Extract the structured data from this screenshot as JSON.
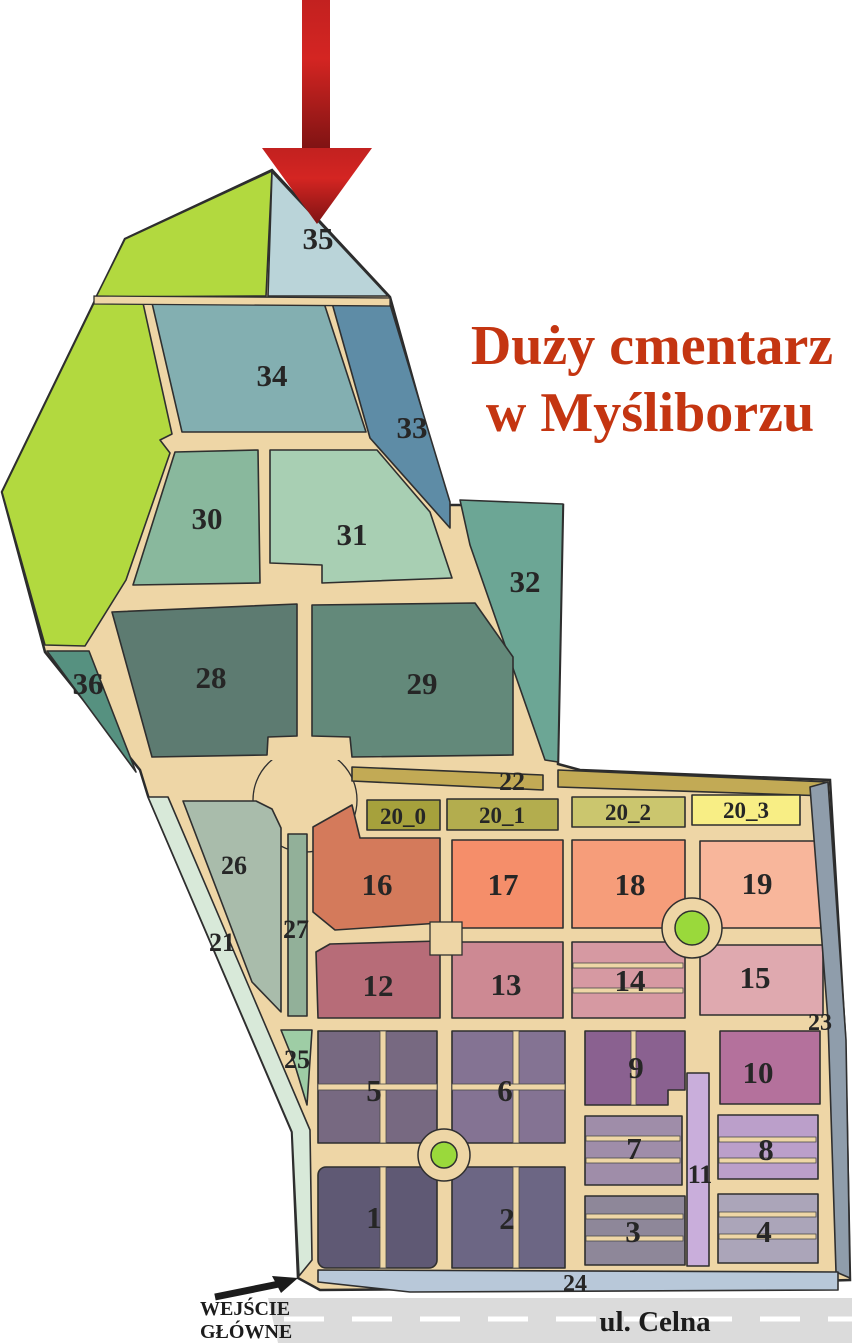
{
  "title": {
    "line1": "Duży cmentarz",
    "line2": "w Myśliborzu",
    "color": "#c43511"
  },
  "road": {
    "name": "ul. Celna"
  },
  "entrance": {
    "line1": "WEJŚCIE",
    "line2": "GŁÓWNE"
  },
  "icons": {
    "pointer_arrow": "big-red-down-arrow",
    "entrance_arrow": "small-black-up-right-arrow"
  },
  "colors": {
    "path": "#eed6a6",
    "outline": "#2f2f2f",
    "label": "#262626",
    "road_grey": "#dbdbdb",
    "road_dash": "#ffffff",
    "roundabout_green": "#9ad93b",
    "arrow_red_bright": "#d92b21",
    "arrow_red_dark": "#7e1313",
    "green_area": "#b2d93f"
  },
  "sections": {
    "s35": {
      "label": "35",
      "color": "#bad4d9"
    },
    "s34": {
      "label": "34",
      "color": "#83afb1"
    },
    "s33": {
      "label": "33",
      "color": "#5e8ca6"
    },
    "s30": {
      "label": "30",
      "color": "#89b89d"
    },
    "s31": {
      "label": "31",
      "color": "#a8cfb3"
    },
    "s32": {
      "label": "32",
      "color": "#6ca695"
    },
    "s36": {
      "label": "36",
      "color": "#569180"
    },
    "s28": {
      "label": "28",
      "color": "#5d7b71"
    },
    "s29": {
      "label": "29",
      "color": "#63897a"
    },
    "s22": {
      "label": "22",
      "color": "#c2aa55"
    },
    "s20_0": {
      "label": "20_0",
      "color": "#a6a13c"
    },
    "s20_1": {
      "label": "20_1",
      "color": "#b3ad4e"
    },
    "s20_2": {
      "label": "20_2",
      "color": "#cbc66e"
    },
    "s20_3": {
      "label": "20_3",
      "color": "#f8ee85"
    },
    "s26": {
      "label": "26",
      "color": "#a9bcab"
    },
    "s27": {
      "label": "27",
      "color": "#92b099"
    },
    "s21": {
      "label": "21",
      "color": "#d8e9d9"
    },
    "s25": {
      "label": "25",
      "color": "#9ecda5"
    },
    "s16": {
      "label": "16",
      "color": "#d47a5b"
    },
    "s17": {
      "label": "17",
      "color": "#f58e6a"
    },
    "s18": {
      "label": "18",
      "color": "#f69d7a"
    },
    "s19": {
      "label": "19",
      "color": "#f8b69b"
    },
    "s12": {
      "label": "12",
      "color": "#b76c78"
    },
    "s13": {
      "label": "13",
      "color": "#cd8993"
    },
    "s14": {
      "label": "14",
      "color": "#d699a2"
    },
    "s15": {
      "label": "15",
      "color": "#dfa9af"
    },
    "s23": {
      "label": "23",
      "color": "#8f9dab"
    },
    "s5": {
      "label": "5",
      "color": "#776981"
    },
    "s6": {
      "label": "6",
      "color": "#847393"
    },
    "s9": {
      "label": "9",
      "color": "#8a6190"
    },
    "s10": {
      "label": "10",
      "color": "#b4719c"
    },
    "s7": {
      "label": "7",
      "color": "#9f8da9"
    },
    "s8": {
      "label": "8",
      "color": "#bb9fca"
    },
    "s11": {
      "label": "11",
      "color": "#c9aedb"
    },
    "s1": {
      "label": "1",
      "color": "#5f5974"
    },
    "s2": {
      "label": "2",
      "color": "#6c6684"
    },
    "s3": {
      "label": "3",
      "color": "#8e8799"
    },
    "s4": {
      "label": "4",
      "color": "#aba5b9"
    },
    "s24": {
      "label": "24",
      "color": "#b8c8d9"
    }
  }
}
